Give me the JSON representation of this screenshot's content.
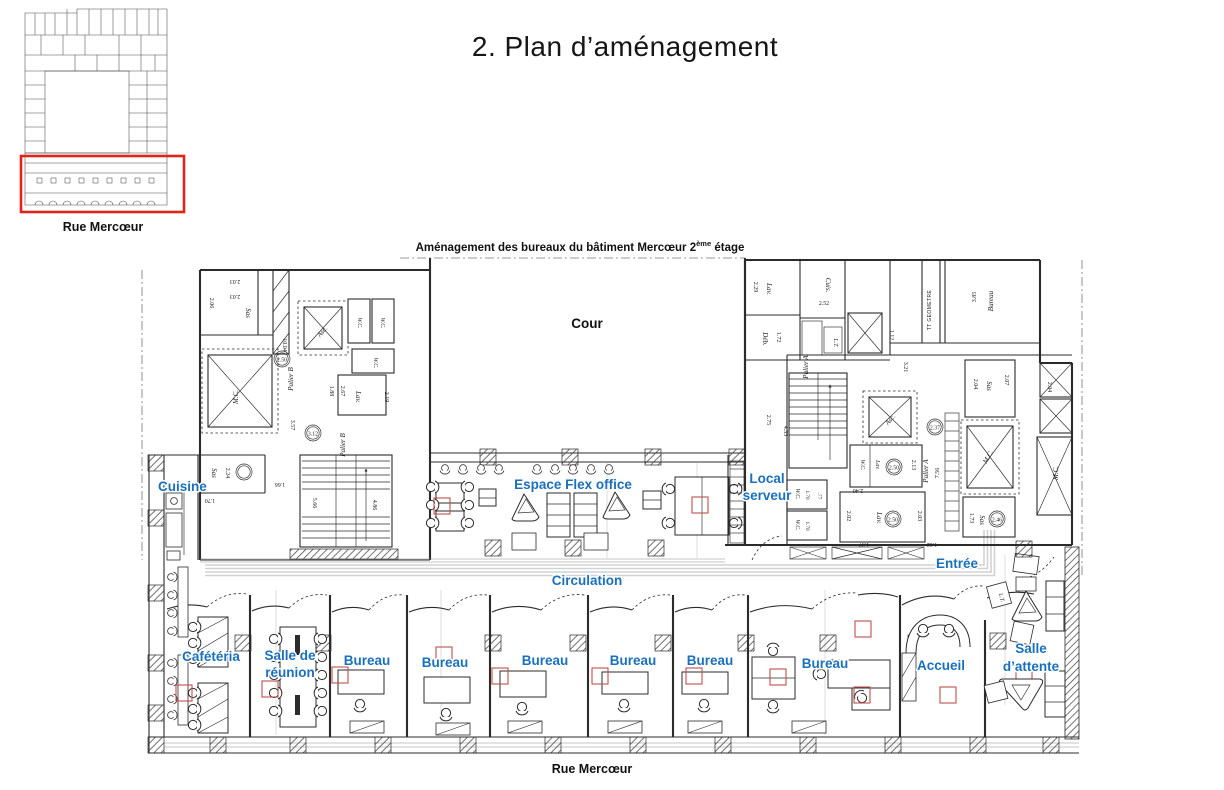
{
  "page": {
    "title": "2. Plan d’aménagement"
  },
  "overview": {
    "street_label": "Rue Mercœur",
    "highlight_color": "#df241a"
  },
  "caption": {
    "main": "Aménagement des bureaux du bâtiment Mercœur 2",
    "sup": "ème",
    "tail": " étage"
  },
  "plan": {
    "accent_color": "#1a70bd",
    "marker_color": "#c0504d",
    "street_label": "Rue Mercœur",
    "courtyard_label": "Cour",
    "labels": {
      "cuisine": "Cuisine",
      "flex_office": "Espace Flex office",
      "local_serveur": [
        "Local",
        "serveur"
      ],
      "entree": "Entrée",
      "circulation": "Circulation",
      "cafeteria": "Cafétéria",
      "salle_reunion": [
        "Salle de",
        "réunion"
      ],
      "bureaus": [
        "Bureau",
        "Bureau",
        "Bureau",
        "Bureau",
        "Bureau",
        "Bureau"
      ],
      "accueil": "Accueil",
      "salle_attente": [
        "Salle",
        "d’attente"
      ]
    },
    "annotations": [
      "2.03",
      "2.03",
      "Sas",
      "2.06",
      "M.C.",
      "10.04",
      "Palier B",
      "2.50",
      "Asc.",
      "W.C.",
      "W.C.",
      "W.C.",
      "Lav.",
      "3.12",
      "Sas",
      "2.24",
      "1.70",
      "Palier B",
      "3.57",
      "1.66",
      "5.66",
      "4.86",
      "1.88",
      "2.67",
      "2.19",
      "Lav.",
      "2.29",
      "Déb.",
      "1.72",
      "Cuis.",
      "2.52",
      "L.T.",
      "1.12",
      "TT GEOMETRE",
      "Bureau",
      "3.85",
      "Palier A",
      "Asc.",
      "4.33",
      "2.37",
      "W.C.",
      "Lav.",
      "2.50",
      "2.40",
      "2.13",
      "Palier A",
      "7.56",
      "Lav.",
      "2.50",
      "2.02",
      "2.03",
      "1.97",
      "1.62",
      "W.C.",
      "1.70",
      ".77",
      "W.C.",
      "1.70",
      "2.75",
      "Sas",
      "2.04",
      "2.07",
      "M.C.",
      "Sas",
      "1.73",
      "2.46",
      "2.04",
      "M.C.",
      "L.T.",
      "3.21"
    ]
  }
}
